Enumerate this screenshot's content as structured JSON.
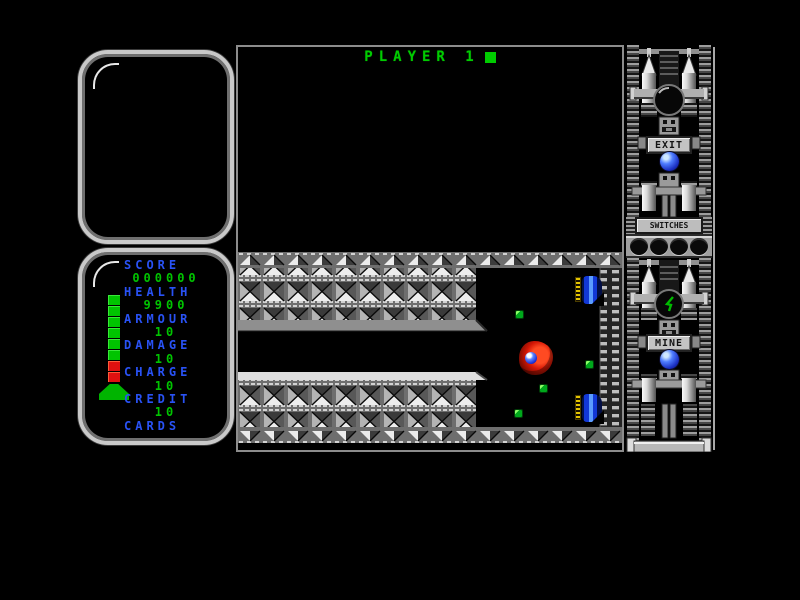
{
  "hud": {
    "title": "PLAYER 1",
    "stats": [
      {
        "label": "SCORE",
        "value": "000000"
      },
      {
        "label": "HEALTH",
        "value": "9900"
      },
      {
        "label": "ARMOUR",
        "value": "10"
      },
      {
        "label": "DAMAGE",
        "value": "10"
      },
      {
        "label": "CHARGE",
        "value": "10"
      },
      {
        "label": "CREDIT",
        "value": "10"
      },
      {
        "label": "CARDS",
        "value": ""
      }
    ],
    "health_bar": {
      "green_segments": 6,
      "red_segments": 2
    }
  },
  "tower": {
    "exit_label": "EXIT",
    "mine_label": "MINE",
    "switches_label": "SWITCHES",
    "switch_count": 4
  },
  "playfield": {
    "sprites": [
      {
        "type": "creature",
        "x": 281,
        "y": 294
      },
      {
        "type": "turret",
        "x": 337,
        "y": 229
      },
      {
        "type": "turret",
        "x": 337,
        "y": 347
      },
      {
        "type": "pickup",
        "x": 278,
        "y": 264
      },
      {
        "type": "pickup",
        "x": 348,
        "y": 314
      },
      {
        "type": "pickup",
        "x": 302,
        "y": 338
      },
      {
        "type": "pickup",
        "x": 277,
        "y": 363
      }
    ]
  },
  "colors": {
    "hud_green": "#00c400",
    "hud_blue": "#2952f5",
    "bar_red": "#e01010",
    "wall_gray": "#6e6e6e",
    "orb_blue": "#1a2ec0"
  }
}
